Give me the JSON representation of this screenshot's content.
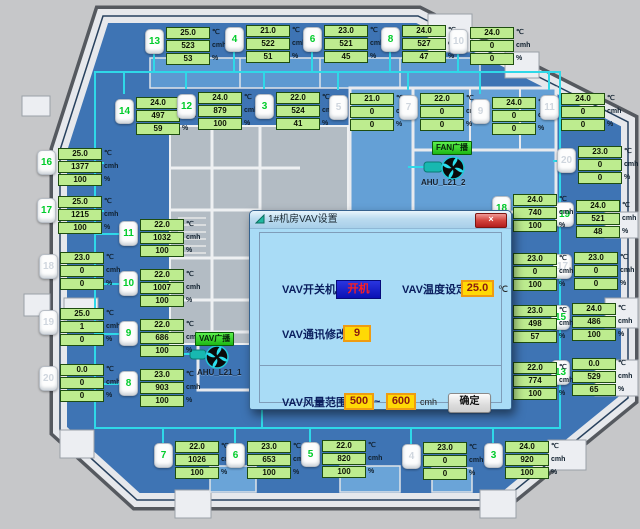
{
  "dialog": {
    "title": "1#机房VAV设置",
    "close_label": "×",
    "switch_label": "VAV开关机",
    "switch_value": "开机",
    "temp_label": "VAV温度设定",
    "temp_value": "25.0",
    "temp_unit": "℃",
    "comm_label": "VAV通讯修改",
    "comm_value": "9",
    "range_label": "VAV风量范围",
    "range_min": "500",
    "range_tilde": "~",
    "range_max": "600",
    "range_unit": "cmh",
    "confirm_label": "确定"
  },
  "units_legend": {
    "temp": "℃",
    "flow": "cmh",
    "pct": "%"
  },
  "fans": [
    {
      "button": "FAN广播",
      "label": "AHU_L21_2",
      "btn_x": 432,
      "btn_y": 141,
      "lbl_x": 421,
      "lbl_y": 178,
      "fan_x": 453,
      "fan_y": 168
    },
    {
      "button": "VAV广播",
      "label": "AHU_L21_1",
      "btn_x": 195,
      "btn_y": 332,
      "lbl_x": 197,
      "lbl_y": 368,
      "fan_x": 217,
      "fan_y": 357
    }
  ],
  "vav_units": [
    {
      "num": "13",
      "on": true,
      "temp": "25.0",
      "flow": "523",
      "pct": "53",
      "x": 166,
      "y": 27
    },
    {
      "num": "4",
      "on": true,
      "temp": "21.0",
      "flow": "522",
      "pct": "51",
      "x": 246,
      "y": 25
    },
    {
      "num": "6",
      "on": true,
      "temp": "23.0",
      "flow": "521",
      "pct": "45",
      "x": 324,
      "y": 25
    },
    {
      "num": "8",
      "on": true,
      "temp": "24.0",
      "flow": "527",
      "pct": "47",
      "x": 402,
      "y": 25
    },
    {
      "num": "10",
      "on": false,
      "temp": "24.0",
      "flow": "0",
      "pct": "0",
      "x": 470,
      "y": 27
    },
    {
      "num": "14",
      "on": true,
      "temp": "24.0",
      "flow": "497",
      "pct": "59",
      "x": 136,
      "y": 97
    },
    {
      "num": "12",
      "on": true,
      "temp": "24.0",
      "flow": "879",
      "pct": "100",
      "x": 198,
      "y": 92
    },
    {
      "num": "3",
      "on": true,
      "temp": "22.0",
      "flow": "524",
      "pct": "41",
      "x": 276,
      "y": 92
    },
    {
      "num": "5",
      "on": false,
      "temp": "21.0",
      "flow": "0",
      "pct": "0",
      "x": 350,
      "y": 93
    },
    {
      "num": "7",
      "on": false,
      "temp": "22.0",
      "flow": "0",
      "pct": "0",
      "x": 420,
      "y": 93
    },
    {
      "num": "9",
      "on": false,
      "temp": "24.0",
      "flow": "0",
      "pct": "0",
      "x": 492,
      "y": 97
    },
    {
      "num": "11",
      "on": false,
      "temp": "24.0",
      "flow": "0",
      "pct": "0",
      "x": 561,
      "y": 93
    },
    {
      "num": "16",
      "on": true,
      "temp": "25.0",
      "flow": "1377",
      "pct": "100",
      "x": 58,
      "y": 148
    },
    {
      "num": "17",
      "on": true,
      "temp": "25.0",
      "flow": "1215",
      "pct": "100",
      "x": 58,
      "y": 196
    },
    {
      "num": "18",
      "on": false,
      "temp": "23.0",
      "flow": "0",
      "pct": "0",
      "x": 60,
      "y": 252
    },
    {
      "num": "19",
      "on": false,
      "temp": "25.0",
      "flow": "1",
      "pct": "0",
      "x": 60,
      "y": 308
    },
    {
      "num": "20",
      "on": false,
      "temp": "0.0",
      "flow": "0",
      "pct": "0",
      "x": 60,
      "y": 364
    },
    {
      "num": "20",
      "on": false,
      "temp": "23.0",
      "flow": "0",
      "pct": "0",
      "x": 578,
      "y": 146
    },
    {
      "num": "19",
      "on": true,
      "temp": "24.0",
      "flow": "521",
      "pct": "48",
      "x": 576,
      "y": 200
    },
    {
      "num": "17",
      "on": false,
      "temp": "23.0",
      "flow": "0",
      "pct": "0",
      "x": 574,
      "y": 252
    },
    {
      "num": "15",
      "on": true,
      "temp": "24.0",
      "flow": "486",
      "pct": "100",
      "x": 572,
      "y": 303
    },
    {
      "num": "13",
      "on": true,
      "temp": "0.0",
      "flow": "529",
      "pct": "65",
      "x": 572,
      "y": 358
    },
    {
      "num": "11",
      "on": true,
      "temp": "22.0",
      "flow": "1032",
      "pct": "100",
      "x": 140,
      "y": 219
    },
    {
      "num": "10",
      "on": true,
      "temp": "22.0",
      "flow": "1007",
      "pct": "100",
      "x": 140,
      "y": 269
    },
    {
      "num": "9",
      "on": true,
      "temp": "22.0",
      "flow": "686",
      "pct": "100",
      "x": 140,
      "y": 319
    },
    {
      "num": "8",
      "on": true,
      "temp": "23.0",
      "flow": "903",
      "pct": "100",
      "x": 140,
      "y": 369
    },
    {
      "num": "18",
      "on": true,
      "temp": "24.0",
      "flow": "740",
      "pct": "100",
      "x": 513,
      "y": 194
    },
    {
      "num": "16",
      "on": true,
      "temp": "23.0",
      "flow": "0",
      "pct": "100",
      "x": 513,
      "y": 253
    },
    {
      "num": "14",
      "on": true,
      "temp": "23.0",
      "flow": "498",
      "pct": "57",
      "x": 513,
      "y": 305
    },
    {
      "num": "12",
      "on": true,
      "temp": "22.0",
      "flow": "774",
      "pct": "100",
      "x": 513,
      "y": 362
    },
    {
      "num": "7",
      "on": true,
      "temp": "22.0",
      "flow": "1026",
      "pct": "100",
      "x": 175,
      "y": 441
    },
    {
      "num": "6",
      "on": true,
      "temp": "23.0",
      "flow": "653",
      "pct": "100",
      "x": 247,
      "y": 441
    },
    {
      "num": "5",
      "on": true,
      "temp": "22.0",
      "flow": "820",
      "pct": "100",
      "x": 322,
      "y": 440
    },
    {
      "num": "4",
      "on": false,
      "temp": "23.0",
      "flow": "0",
      "pct": "0",
      "x": 423,
      "y": 442
    },
    {
      "num": "3",
      "on": true,
      "temp": "24.0",
      "flow": "920",
      "pct": "100",
      "x": 505,
      "y": 441
    }
  ]
}
